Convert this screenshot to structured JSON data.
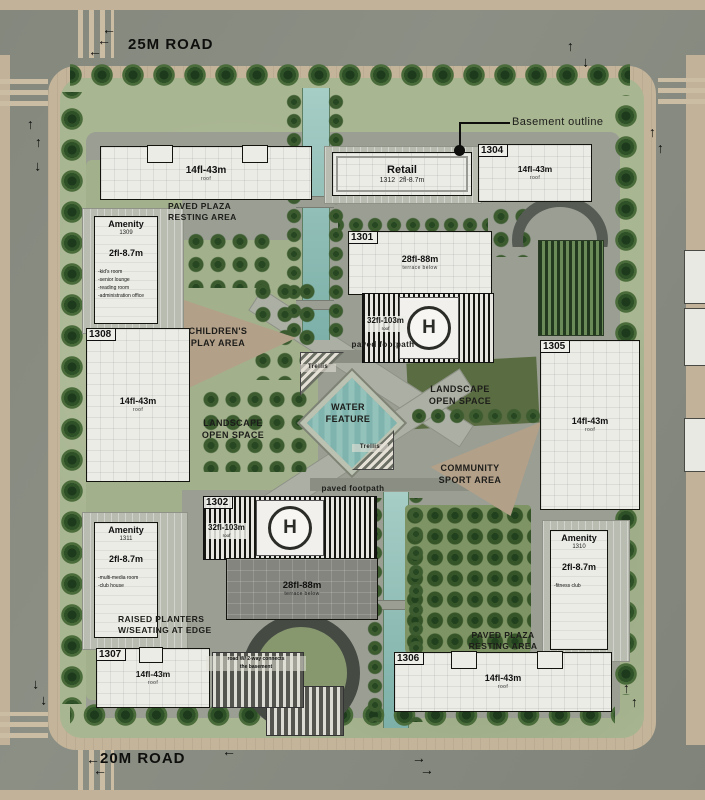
{
  "roads": {
    "top": "25M ROAD",
    "bottom": "20M ROAD"
  },
  "icons": {
    "arrow": "←",
    "helipad": "H"
  },
  "annotations": {
    "basement_outline": "Basement outline",
    "ramp_note_l1": "road W/ 2-way connects",
    "ramp_note_l2": "the basement"
  },
  "buildings": {
    "b_nw": {
      "floors": "14fl-43m",
      "sub": "roof"
    },
    "retail": {
      "name": "Retail",
      "id": "1312",
      "floors": "2fl-8.7m"
    },
    "b1304": {
      "id": "1304",
      "floors": "14fl-43m",
      "sub": "roof"
    },
    "b1301": {
      "id": "1301",
      "slab_floors": "28fl-88m",
      "slab_sub": "terrace below",
      "tower_floors": "32fl-103m",
      "tower_sub": "roof"
    },
    "b1302": {
      "id": "1302",
      "tower_floors": "32fl-103m",
      "tower_sub": "roof",
      "slab_floors": "28fl-88m",
      "slab_sub": "terrace below"
    },
    "b1305": {
      "id": "1305",
      "floors": "14fl-43m",
      "sub": "roof"
    },
    "b1306": {
      "id": "1306",
      "floors": "14fl-43m",
      "sub": "roof"
    },
    "b1307": {
      "id": "1307",
      "floors": "14fl-43m",
      "sub": "roof"
    },
    "b1308": {
      "id": "1308",
      "floors": "14fl-43m",
      "sub": "roof"
    },
    "amenity1309": {
      "title": "Amenity",
      "id": "1309",
      "floors": "2fl-8.7m",
      "n1": "-kid's room",
      "n2": "-senior lounge",
      "n3": "-reading room",
      "n4": "-administration office"
    },
    "amenity1311": {
      "title": "Amenity",
      "id": "1311",
      "floors": "2fl-8.7m",
      "n1": "-multi-media room",
      "n2": "-club house"
    },
    "amenity1310": {
      "title": "Amenity",
      "id": "1310",
      "floors": "2fl-8.7m",
      "n1": "-fitness club"
    }
  },
  "labels": {
    "plaza_l1": "PAVED PLAZA",
    "plaza_l2": "RESTING AREA",
    "play_l1": "CHILDREN'S",
    "play_l2": "PLAY AREA",
    "landscape_l1": "LANDSCAPE",
    "landscape_l2": "OPEN SPACE",
    "water_l1": "WATER",
    "water_l2": "FEATURE",
    "sport_l1": "COMMUNITY",
    "sport_l2": "SPORT AREA",
    "footpath": "paved footpath",
    "trellis": "Trellis",
    "planters_l1": "RAISED PLANTERS",
    "planters_l2": "W/SEATING AT EDGE"
  },
  "colors": {
    "road": "#85897f",
    "sidewalk": "#c4b49a",
    "lawn": "#a9b692",
    "plaza": "#9a9e93",
    "water": "#7fb3ad",
    "play_area": "#b3a089",
    "tree_dark": "#1d3a1c",
    "building": "#ecece7",
    "outline": "#14140f"
  }
}
